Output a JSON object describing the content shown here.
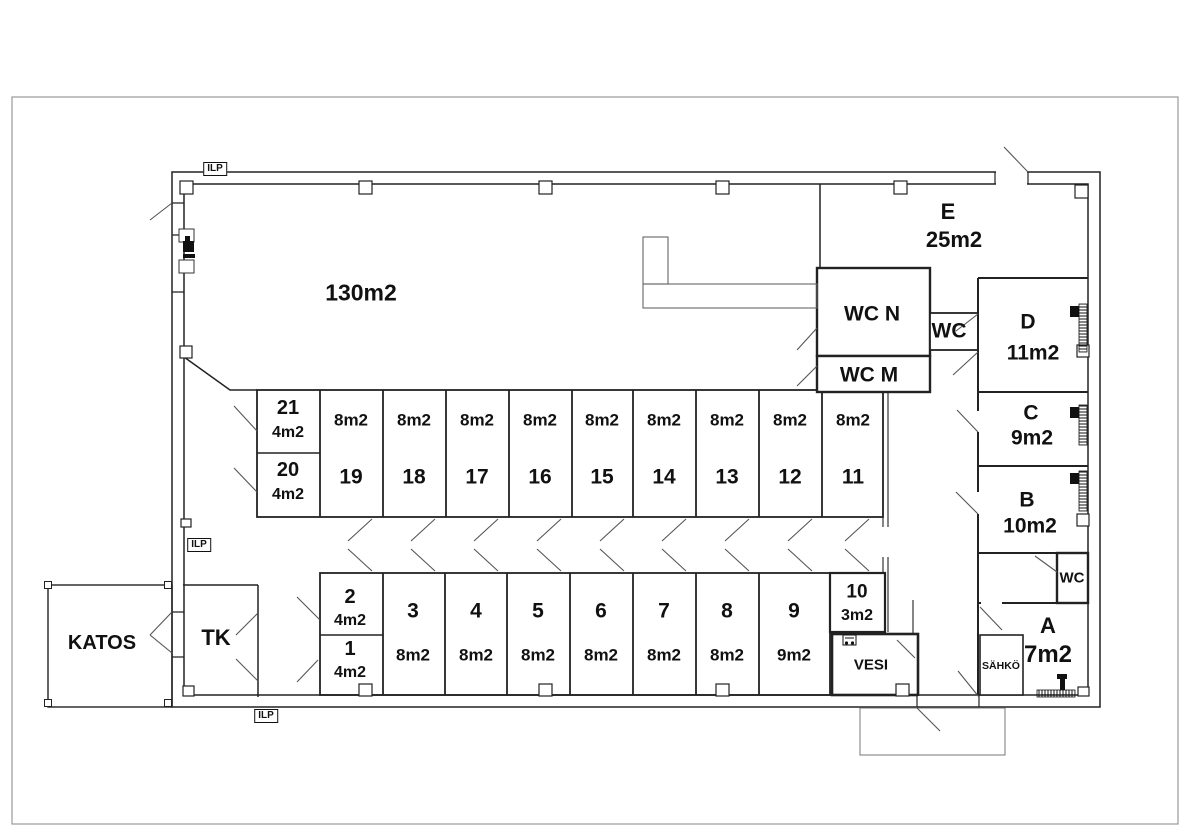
{
  "labels": {
    "ilp": "ILP",
    "hall": "130m2",
    "katos": "KATOS",
    "tk": "TK",
    "vesi": "VESI",
    "sahko": "SÄHKÖ",
    "wc_n": "WC N",
    "wc_m": "WC M",
    "wc_mid": "WC",
    "wc_small": "WC"
  },
  "rooms": {
    "e": {
      "name": "E",
      "area": "25m2"
    },
    "d": {
      "name": "D",
      "area": "11m2"
    },
    "c": {
      "name": "C",
      "area": "9m2"
    },
    "b": {
      "name": "B",
      "area": "10m2"
    },
    "a": {
      "name": "A",
      "area": "7m2"
    }
  },
  "units_top": [
    {
      "num": "21",
      "area": "4m2"
    },
    {
      "num": "20",
      "area": "4m2"
    },
    {
      "num": "19",
      "area": "8m2"
    },
    {
      "num": "18",
      "area": "8m2"
    },
    {
      "num": "17",
      "area": "8m2"
    },
    {
      "num": "16",
      "area": "8m2"
    },
    {
      "num": "15",
      "area": "8m2"
    },
    {
      "num": "14",
      "area": "8m2"
    },
    {
      "num": "13",
      "area": "8m2"
    },
    {
      "num": "12",
      "area": "8m2"
    },
    {
      "num": "11",
      "area": "8m2"
    }
  ],
  "units_bottom": [
    {
      "num": "2",
      "area": "4m2"
    },
    {
      "num": "1",
      "area": "4m2"
    },
    {
      "num": "3",
      "area": "8m2"
    },
    {
      "num": "4",
      "area": "8m2"
    },
    {
      "num": "5",
      "area": "8m2"
    },
    {
      "num": "6",
      "area": "8m2"
    },
    {
      "num": "7",
      "area": "8m2"
    },
    {
      "num": "8",
      "area": "8m2"
    },
    {
      "num": "9",
      "area": "9m2"
    },
    {
      "num": "10",
      "area": "3m2"
    }
  ],
  "icons": {
    "heat_pump": "heat-pump-icon",
    "water_meter": "water-meter-icon",
    "electric_meter": "electric-meter-icon",
    "electric_heater": "electric-heater-icon"
  },
  "colors": {
    "wall": "#222222",
    "swing": "#555555",
    "sheet_border": "#999999"
  }
}
